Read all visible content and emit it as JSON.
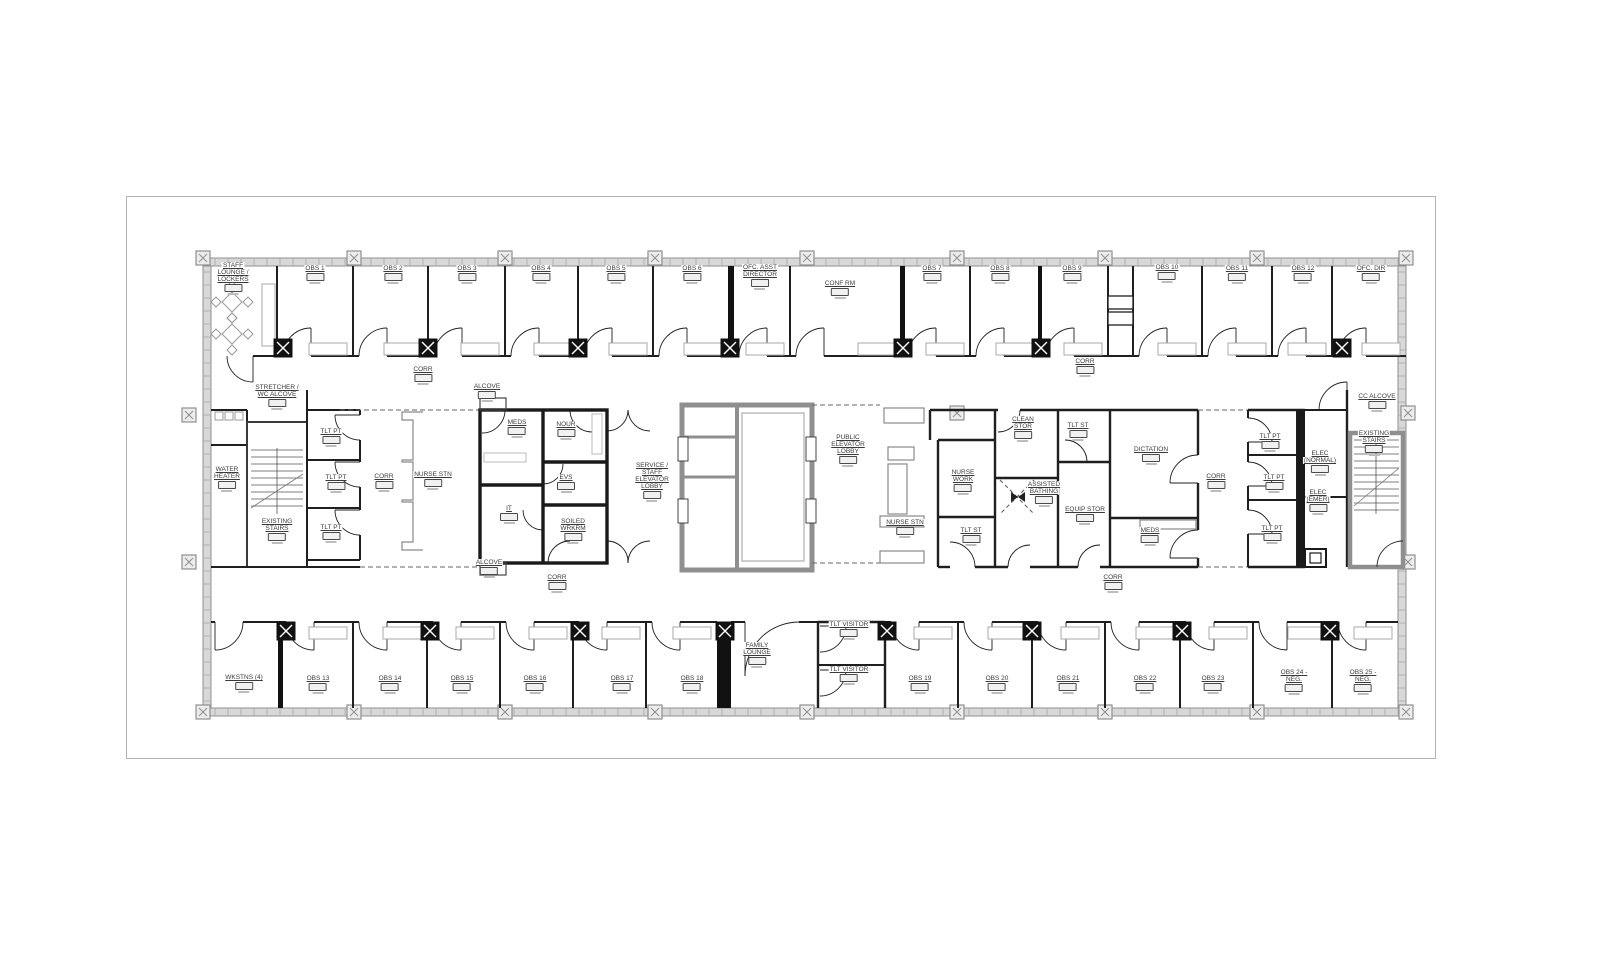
{
  "sheet": {
    "kind": "architectural floor plan",
    "colors": {
      "wall_ink": "#1f1f1f",
      "exterior_gray": "#8f8f8f",
      "label_text": "#3a3a3a",
      "paper": "#ffffff"
    }
  },
  "rooms": [
    {
      "id": "staff-lounge-lockers",
      "label": "STAFF\nLOUNGE /\nLOCKERS",
      "x": 233,
      "y": 270
    },
    {
      "id": "obs-1",
      "label": "OBS 1",
      "x": 315,
      "y": 273
    },
    {
      "id": "obs-2",
      "label": "OBS 2",
      "x": 393,
      "y": 273
    },
    {
      "id": "obs-3",
      "label": "OBS 3",
      "x": 467,
      "y": 273
    },
    {
      "id": "obs-4",
      "label": "OBS 4",
      "x": 541,
      "y": 273
    },
    {
      "id": "obs-5",
      "label": "OBS 5",
      "x": 616,
      "y": 273
    },
    {
      "id": "obs-6",
      "label": "OBS 6",
      "x": 692,
      "y": 273
    },
    {
      "id": "ofc-asst-director",
      "label": "OFC. ASST\nDIRECTOR",
      "x": 760,
      "y": 272
    },
    {
      "id": "conf-rm",
      "label": "CONF RM",
      "x": 840,
      "y": 288
    },
    {
      "id": "obs-7",
      "label": "OBS 7",
      "x": 932,
      "y": 273
    },
    {
      "id": "obs-8",
      "label": "OBS 8",
      "x": 1000,
      "y": 273
    },
    {
      "id": "obs-9",
      "label": "OBS 9",
      "x": 1072,
      "y": 273
    },
    {
      "id": "obs-10",
      "label": "OBS 10",
      "x": 1167,
      "y": 272
    },
    {
      "id": "obs-11",
      "label": "OBS 11",
      "x": 1237,
      "y": 273
    },
    {
      "id": "obs-12",
      "label": "OBS 12",
      "x": 1303,
      "y": 273
    },
    {
      "id": "ofc-dir",
      "label": "OFC. DIR",
      "x": 1371,
      "y": 273
    },
    {
      "id": "corr-upper-left",
      "label": "CORR",
      "x": 423,
      "y": 374
    },
    {
      "id": "corr-upper-right",
      "label": "CORR",
      "x": 1085,
      "y": 366
    },
    {
      "id": "stretcher-wc-alcove",
      "label": "STRETCHER /\nWC ALCOVE",
      "x": 277,
      "y": 392
    },
    {
      "id": "water-heater",
      "label": "WATER\nHEATER",
      "x": 227,
      "y": 474
    },
    {
      "id": "existing-stairs-left",
      "label": "EXISTING\nSTAIRS",
      "x": 277,
      "y": 526
    },
    {
      "id": "tlt-pt-left-1",
      "label": "TLT PT",
      "x": 331,
      "y": 436
    },
    {
      "id": "tlt-pt-left-2",
      "label": "TLT PT",
      "x": 336,
      "y": 482
    },
    {
      "id": "tlt-pt-left-3",
      "label": "TLT PT",
      "x": 331,
      "y": 532
    },
    {
      "id": "corr-left",
      "label": "CORR",
      "x": 384,
      "y": 481
    },
    {
      "id": "nurse-stn-left",
      "label": "NURSE STN",
      "x": 433,
      "y": 479
    },
    {
      "id": "alcove-upper",
      "label": "ALCOVE",
      "x": 487,
      "y": 391
    },
    {
      "id": "meds-left",
      "label": "MEDS",
      "x": 517,
      "y": 427
    },
    {
      "id": "nour",
      "label": "NOUR",
      "x": 566,
      "y": 429
    },
    {
      "id": "evs",
      "label": "EVS",
      "x": 566,
      "y": 482
    },
    {
      "id": "it",
      "label": "IT",
      "x": 509,
      "y": 513
    },
    {
      "id": "soiled-wrkrm",
      "label": "SOILED\nWRKRM",
      "x": 573,
      "y": 526
    },
    {
      "id": "alcove-lower",
      "label": "ALCOVE",
      "x": 489,
      "y": 567
    },
    {
      "id": "service-staff-elevator-lobby",
      "label": "SERVICE /\nSTAFF\nELEVATOR\nLOBBY",
      "x": 652,
      "y": 470
    },
    {
      "id": "public-elevator-lobby",
      "label": "PUBLIC\nELEVATOR\nLOBBY",
      "x": 848,
      "y": 442
    },
    {
      "id": "nurse-stn-center",
      "label": "NURSE STN",
      "x": 905,
      "y": 527
    },
    {
      "id": "nurse-work",
      "label": "NURSE\nWORK",
      "x": 963,
      "y": 477
    },
    {
      "id": "tlt-st-lower",
      "label": "TLT ST",
      "x": 971,
      "y": 535
    },
    {
      "id": "clean-stor",
      "label": "CLEAN\nSTOR",
      "x": 1023,
      "y": 424
    },
    {
      "id": "assisted-bathing",
      "label": "ASSISTED\nBATHING",
      "x": 1044,
      "y": 489
    },
    {
      "id": "tlt-st-upper",
      "label": "TLT ST",
      "x": 1078,
      "y": 430
    },
    {
      "id": "equip-stor",
      "label": "EQUIP STOR",
      "x": 1085,
      "y": 514
    },
    {
      "id": "dictation",
      "label": "DICTATION",
      "x": 1151,
      "y": 454
    },
    {
      "id": "meds-right",
      "label": "MEDS",
      "x": 1150,
      "y": 535
    },
    {
      "id": "corr-right",
      "label": "CORR",
      "x": 1216,
      "y": 481
    },
    {
      "id": "tlt-pt-right-1",
      "label": "TLT PT",
      "x": 1270,
      "y": 441
    },
    {
      "id": "tlt-pt-right-2",
      "label": "TLT PT",
      "x": 1274,
      "y": 482
    },
    {
      "id": "tlt-pt-right-3",
      "label": "TLT PT",
      "x": 1272,
      "y": 533
    },
    {
      "id": "elec-normal",
      "label": "ELEC\n(NORMAL)",
      "x": 1320,
      "y": 458
    },
    {
      "id": "elec-emer",
      "label": "ELEC\n(EMER)",
      "x": 1318,
      "y": 497
    },
    {
      "id": "cc-alcove",
      "label": "CC ALCOVE",
      "x": 1377,
      "y": 401
    },
    {
      "id": "existing-stairs-right",
      "label": "EXISTING\nSTAIRS",
      "x": 1374,
      "y": 438
    },
    {
      "id": "corr-lower-left",
      "label": "CORR",
      "x": 557,
      "y": 582
    },
    {
      "id": "corr-lower-right",
      "label": "CORR",
      "x": 1113,
      "y": 582
    },
    {
      "id": "wkstns-4",
      "label": "WKSTNS (4)",
      "x": 244,
      "y": 682
    },
    {
      "id": "obs-13",
      "label": "OBS 13",
      "x": 318,
      "y": 683
    },
    {
      "id": "obs-14",
      "label": "OBS 14",
      "x": 390,
      "y": 683
    },
    {
      "id": "obs-15",
      "label": "OBS 15",
      "x": 462,
      "y": 683
    },
    {
      "id": "obs-16",
      "label": "OBS 16",
      "x": 535,
      "y": 683
    },
    {
      "id": "obs-17",
      "label": "OBS 17",
      "x": 622,
      "y": 683
    },
    {
      "id": "obs-18",
      "label": "OBS 18",
      "x": 692,
      "y": 683
    },
    {
      "id": "family-lounge",
      "label": "FAMILY\nLOUNGE",
      "x": 757,
      "y": 650
    },
    {
      "id": "tlt-visitor-upper",
      "label": "TLT VISITOR",
      "x": 849,
      "y": 629
    },
    {
      "id": "tlt-visitor-lower",
      "label": "TLT VISITOR",
      "x": 849,
      "y": 674
    },
    {
      "id": "obs-19",
      "label": "OBS 19",
      "x": 920,
      "y": 683
    },
    {
      "id": "obs-20",
      "label": "OBS 20",
      "x": 997,
      "y": 683
    },
    {
      "id": "obs-21",
      "label": "OBS 21",
      "x": 1068,
      "y": 683
    },
    {
      "id": "obs-22",
      "label": "OBS 22",
      "x": 1145,
      "y": 683
    },
    {
      "id": "obs-23",
      "label": "OBS 23",
      "x": 1213,
      "y": 683
    },
    {
      "id": "obs-24-neg",
      "label": "OBS 24 -\nNEG.",
      "x": 1294,
      "y": 677
    },
    {
      "id": "obs-25-neg",
      "label": "OBS 25 -\nNEG.",
      "x": 1363,
      "y": 677
    }
  ]
}
